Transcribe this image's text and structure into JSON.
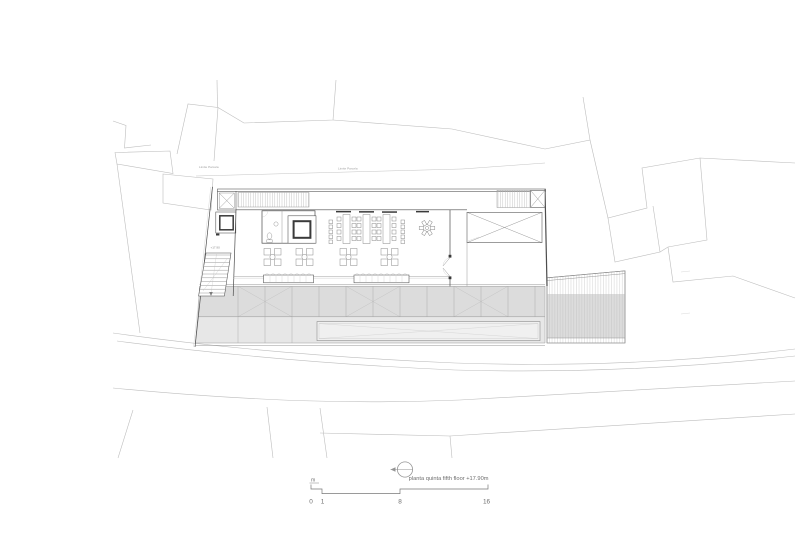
{
  "plan": {
    "caption": "planta quinta fifth floor +17.90m",
    "boundary_label_left": "Limite Parcela",
    "boundary_label_right": "Limite Parcela",
    "level_marker": "+17.90",
    "scale_bar": {
      "unit_label": "m",
      "tick_labels": [
        "0",
        "1",
        "8",
        "16"
      ]
    },
    "colors": {
      "line_strong": "#4d4d4d",
      "line_medium": "#8c8c8c",
      "line_context": "#bdbdbd",
      "terrace_gray": "#dcdcdc",
      "terrace_light": "#e7e7e7",
      "strip_light": "#f0f0f0",
      "hatch_gray": "#bfbfbf",
      "text_gray": "#6e6e6e"
    }
  }
}
